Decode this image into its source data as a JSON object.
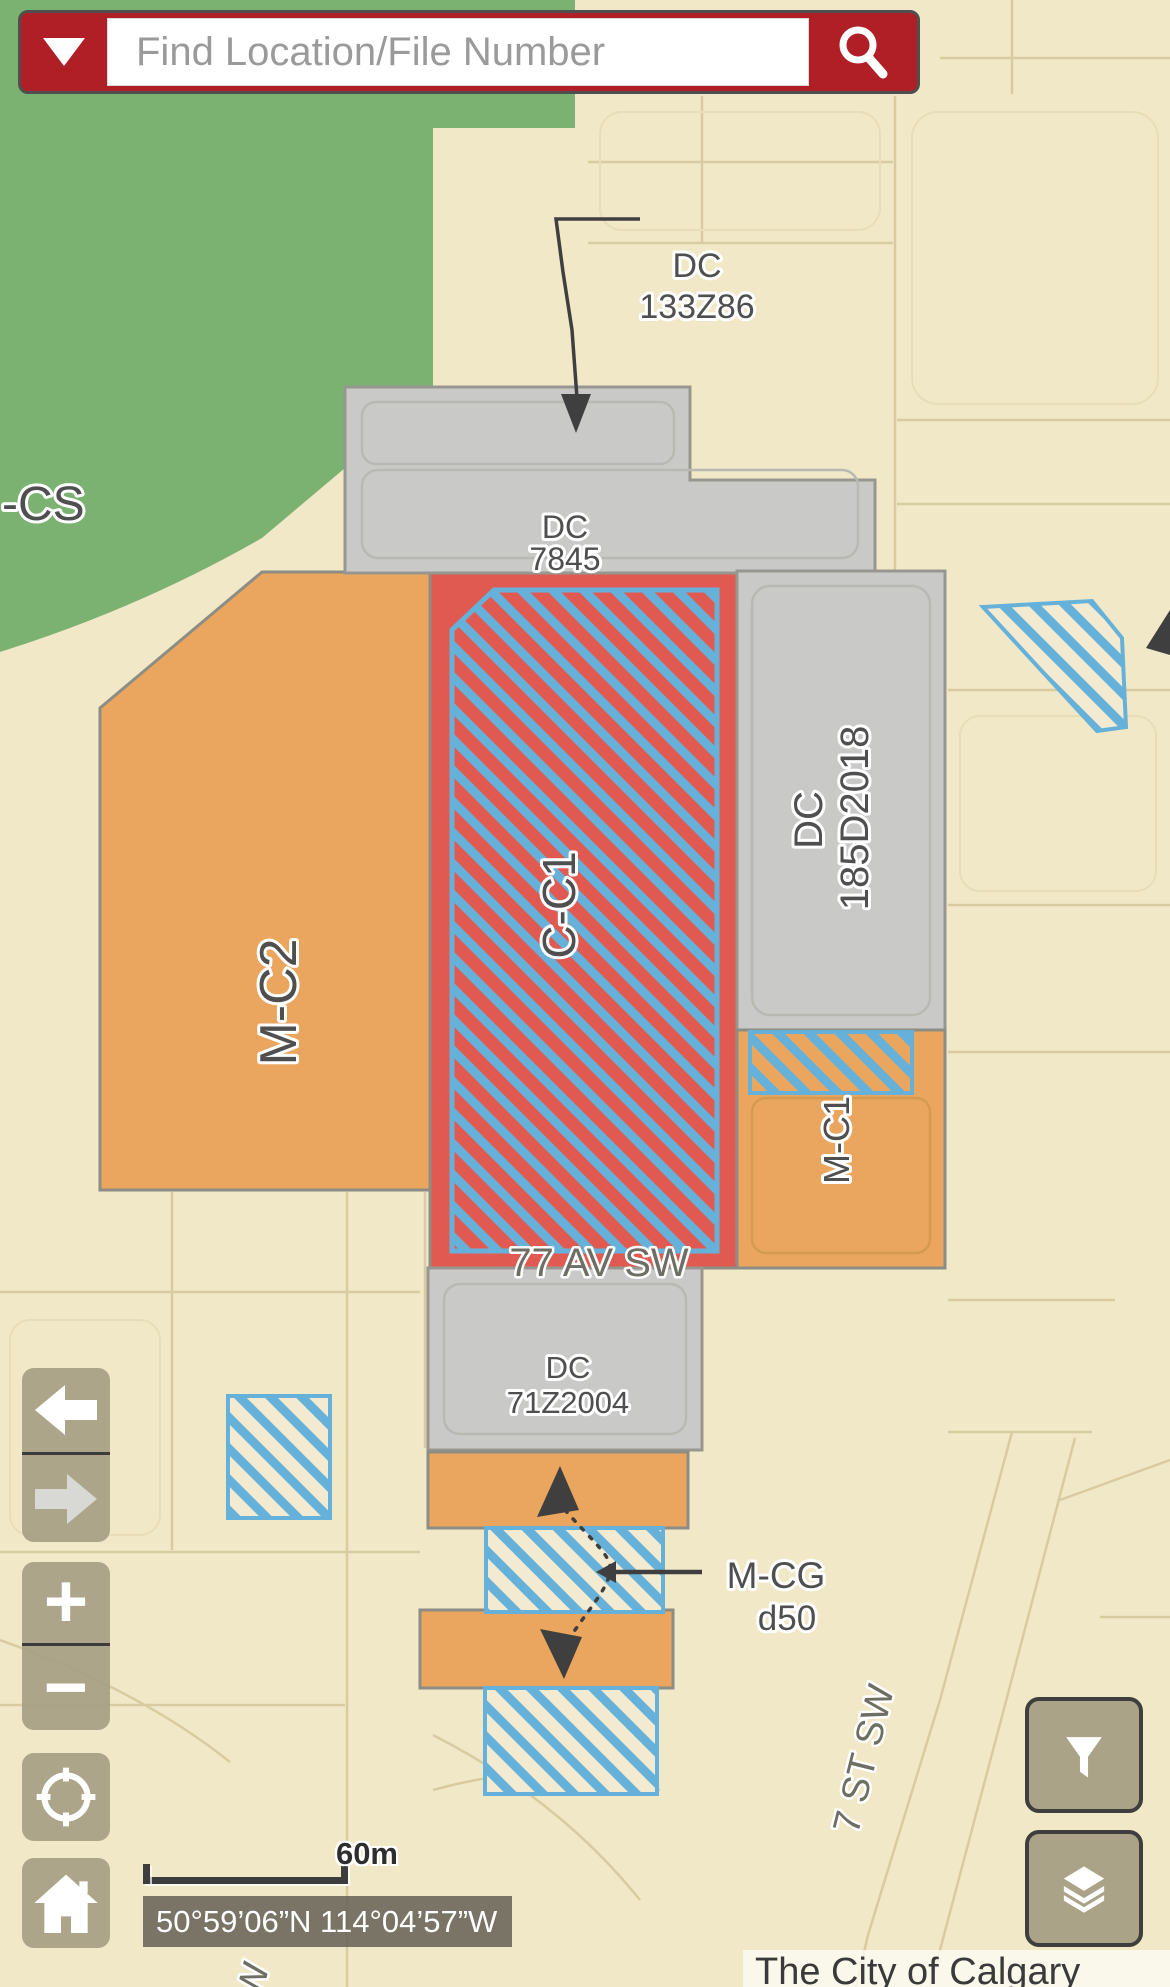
{
  "search": {
    "placeholder": "Find Location/File Number"
  },
  "labels": {
    "rcs": "-CS",
    "dc133z86_l1": "DC",
    "dc133z86_l2": "133Z86",
    "dc7845_l1": "DC",
    "dc7845_l2": "7845",
    "cc1": "C-C1",
    "dc185_l1": "DC",
    "dc185_l2": "185D2018",
    "mc2": "M-C2",
    "mc1": "M-C1",
    "av77": "77 AV SW",
    "dc71_l1": "DC",
    "dc71_l2": "71Z2004",
    "mcg_l1": "M-CG",
    "mcg_l2": "d50",
    "st7": "7 ST SW",
    "street_partial": "SW"
  },
  "controls": {
    "zoom_in": "+",
    "zoom_out": "−"
  },
  "scale_bar": {
    "label": "60m"
  },
  "coordinates": "50°59’06”N 114°04’57”W",
  "attribution": "The City of Calgary",
  "colors": {
    "search_red": "#b01f26",
    "zone_green": "#7cb271",
    "zone_orange": "#eaa65e",
    "zone_red": "#e15a52",
    "zone_gray": "#c9c9c8",
    "hatch_blue": "#66b1d9",
    "basemap_beige": "#f1e8c8",
    "button_tan": "#a79f85"
  }
}
